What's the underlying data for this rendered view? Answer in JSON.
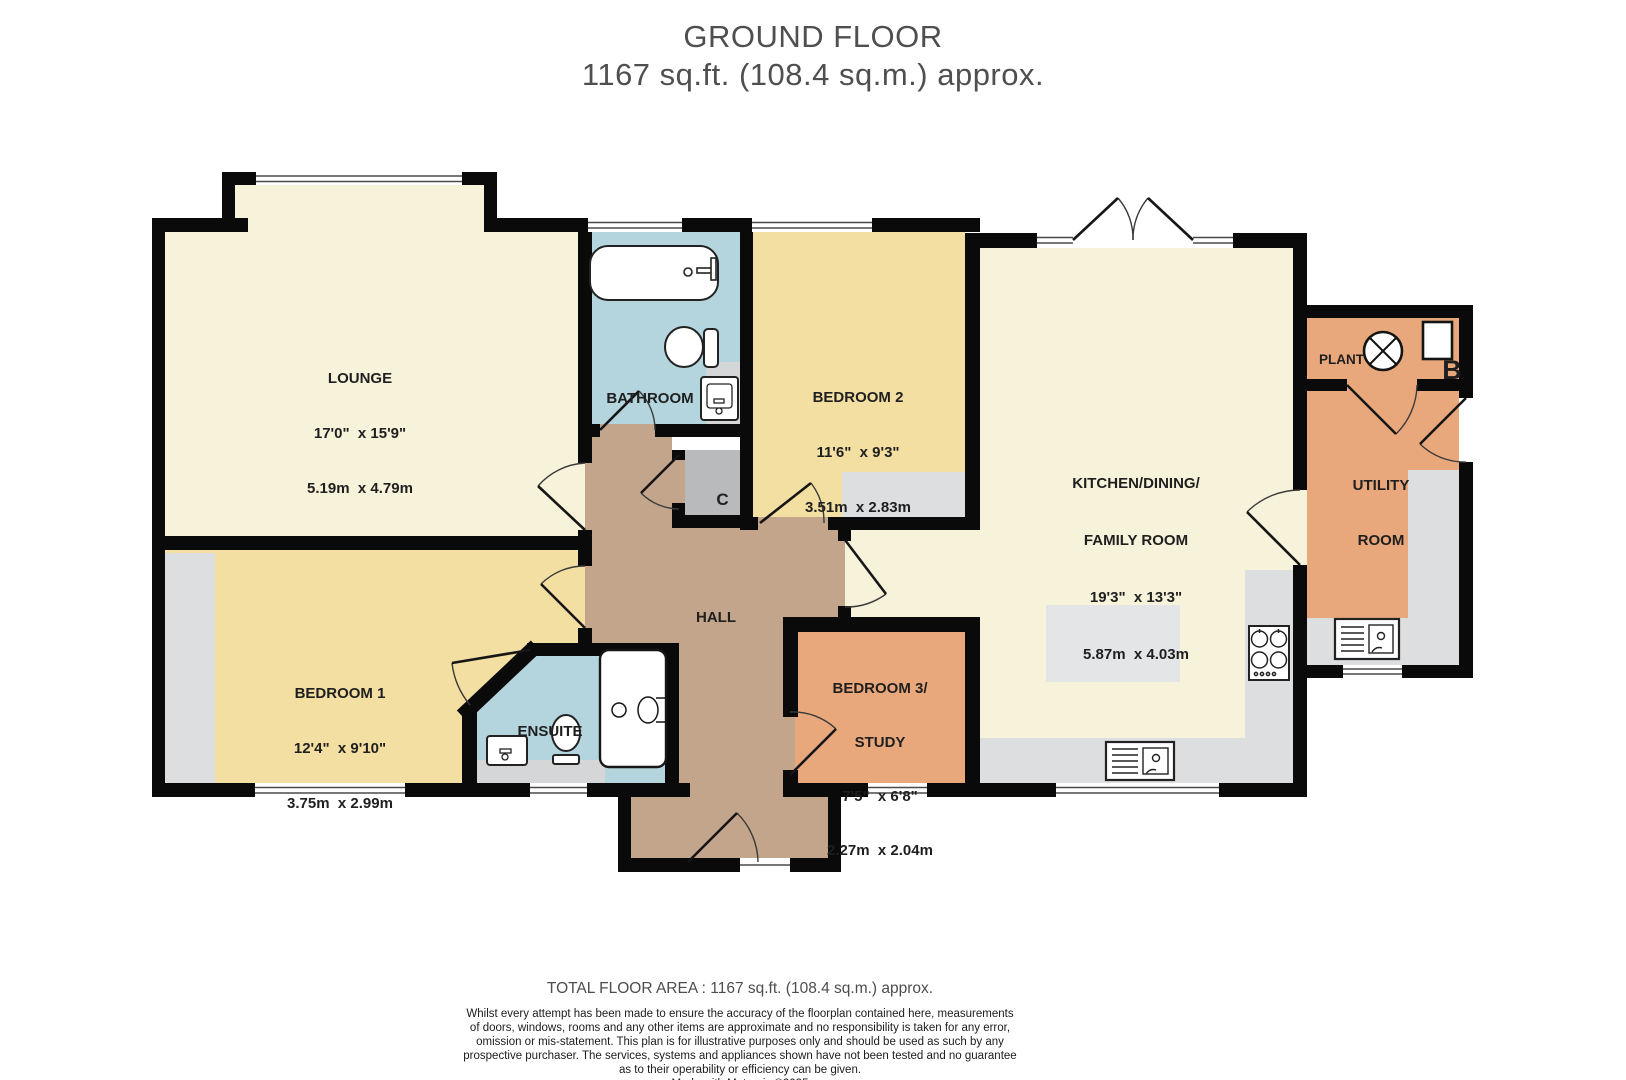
{
  "title": {
    "line1": "GROUND FLOOR",
    "line2": "1167 sq.ft. (108.4 sq.m.) approx."
  },
  "rooms": {
    "lounge": {
      "name": "LOUNGE",
      "imperial": "17'0\"  x 15'9\"",
      "metric": "5.19m  x 4.79m"
    },
    "bathroom": {
      "name": "BATHROOM"
    },
    "bedroom2": {
      "name": "BEDROOM 2",
      "imperial": "11'6\"  x 9'3\"",
      "metric": "3.51m  x 2.83m"
    },
    "kitchen": {
      "name": "KITCHEN/DINING/",
      "name2": "FAMILY ROOM",
      "imperial": "19'3\"  x 13'3\"",
      "metric": "5.87m  x 4.03m"
    },
    "plant": {
      "name": "PLANT"
    },
    "utility": {
      "name": "UTILITY",
      "name2": "ROOM"
    },
    "bedroom1": {
      "name": "BEDROOM 1",
      "imperial": "12'4\"  x 9'10\"",
      "metric": "3.75m  x 2.99m"
    },
    "ensuite": {
      "name": "ENSUITE"
    },
    "hall": {
      "name": "HALL"
    },
    "bedroom3": {
      "name": "BEDROOM 3/",
      "name2": "STUDY",
      "imperial": "7'5\"  x 6'8\"",
      "metric": "2.27m  x 2.04m"
    },
    "cupboard": {
      "name": "C"
    },
    "boiler": {
      "name": "B"
    }
  },
  "footer": {
    "total": "TOTAL FLOOR AREA : 1167 sq.ft. (108.4 sq.m.) approx.",
    "disclaimer": [
      "Whilst every attempt has been made to ensure the accuracy of the floorplan contained here, measurements",
      "of doors, windows, rooms and any other items are approximate and no responsibility is taken for any error,",
      "omission or mis-statement. This plan is for illustrative purposes only and should be used as such by any",
      "prospective purchaser. The services, systems and appliances shown have not been tested and no guarantee",
      "as to their operability or efficiency can be given."
    ],
    "credit": "Made with Metropix ©2025"
  },
  "colors": {
    "wall": "#0a0a0a",
    "cream_room": "#f7f2da",
    "yellow_room": "#f4dfa3",
    "orange_room": "#e9a87c",
    "blue_room": "#b4d5dd",
    "hall_tan": "#c2a58a",
    "counter_gray": "#dcdee0",
    "island_gray": "#e4e5e7",
    "cupboard_gray": "#b9babc",
    "title_gray": "#4f4f4f"
  }
}
